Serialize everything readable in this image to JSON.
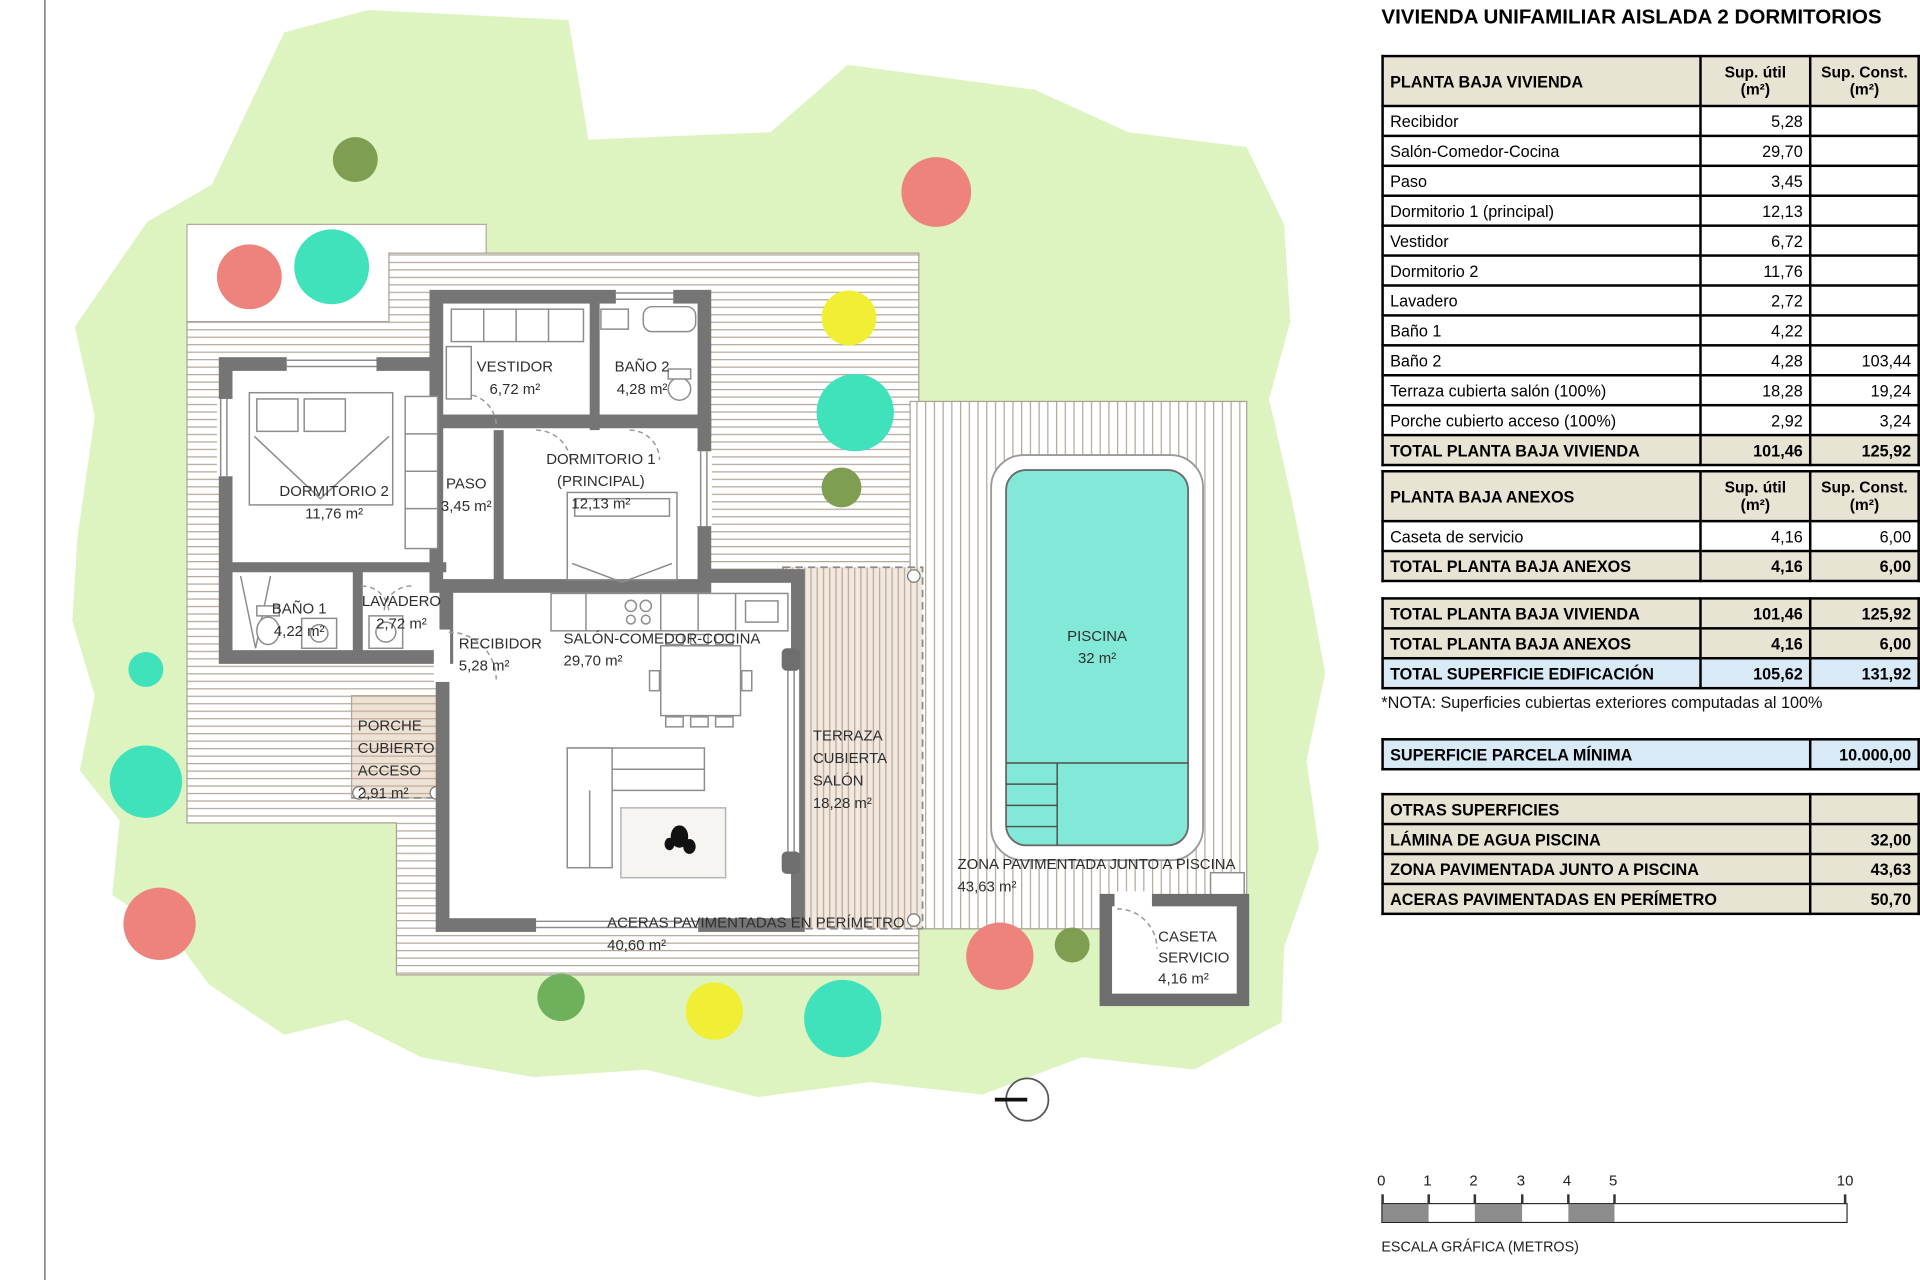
{
  "title": "VIVIENDA UNIFAMILIAR AISLADA 2 DORMITORIOS",
  "tables": {
    "col_util": "Sup. útil\n(m²)",
    "col_const": "Sup. Const.\n(m²)",
    "vivienda": {
      "header": "PLANTA BAJA VIVIENDA",
      "rows": [
        {
          "label": "Recibidor",
          "util": "5,28",
          "const": ""
        },
        {
          "label": "Salón-Comedor-Cocina",
          "util": "29,70",
          "const": ""
        },
        {
          "label": "Paso",
          "util": "3,45",
          "const": ""
        },
        {
          "label": "Dormitorio 1 (principal)",
          "util": "12,13",
          "const": ""
        },
        {
          "label": "Vestidor",
          "util": "6,72",
          "const": ""
        },
        {
          "label": "Dormitorio 2",
          "util": "11,76",
          "const": ""
        },
        {
          "label": "Lavadero",
          "util": "2,72",
          "const": ""
        },
        {
          "label": "Baño 1",
          "util": "4,22",
          "const": ""
        },
        {
          "label": "Baño 2",
          "util": "4,28",
          "const": "103,44"
        },
        {
          "label": "Terraza cubierta salón (100%)",
          "util": "18,28",
          "const": "19,24"
        },
        {
          "label": "Porche cubierto acceso (100%)",
          "util": "2,92",
          "const": "3,24"
        }
      ],
      "total": {
        "label": "TOTAL PLANTA BAJA VIVIENDA",
        "util": "101,46",
        "const": "125,92"
      }
    },
    "anexos": {
      "header": "PLANTA BAJA ANEXOS",
      "rows": [
        {
          "label": "Caseta de servicio",
          "util": "4,16",
          "const": "6,00"
        }
      ],
      "total": {
        "label": "TOTAL PLANTA BAJA ANEXOS",
        "util": "4,16",
        "const": "6,00"
      }
    },
    "resumen": {
      "rows": [
        {
          "label": "TOTAL PLANTA BAJA VIVIENDA",
          "util": "101,46",
          "const": "125,92"
        },
        {
          "label": "TOTAL PLANTA BAJA ANEXOS",
          "util": "4,16",
          "const": "6,00"
        },
        {
          "label": "TOTAL SUPERFICIE EDIFICACIÓN",
          "util": "105,62",
          "const": "131,92"
        }
      ]
    },
    "nota": "*NOTA: Superficies cubiertas exteriores computadas al 100%",
    "parcela": {
      "label": "SUPERFICIE PARCELA MÍNIMA",
      "value": "10.000,00"
    },
    "otras": {
      "header": "OTRAS SUPERFICIES",
      "rows": [
        {
          "label": "LÁMINA DE AGUA PISCINA",
          "value": "32,00"
        },
        {
          "label": "ZONA PAVIMENTADA JUNTO A PISCINA",
          "value": "43,63"
        },
        {
          "label": "ACERAS PAVIMENTADAS EN PERÍMETRO",
          "value": "50,70"
        }
      ]
    }
  },
  "scalebar": {
    "ticks": [
      "0",
      "1",
      "2",
      "3",
      "4",
      "5",
      "10"
    ],
    "label": "ESCALA GRÁFICA (METROS)"
  },
  "plan": {
    "dorm2": {
      "l1": "DORMITORIO 2",
      "area": "11,76 m²"
    },
    "bano1": {
      "l1": "BAÑO 1",
      "area": "4,22 m²"
    },
    "lavadero": {
      "l1": "LAVADERO",
      "area": "2,72 m²"
    },
    "vestidor": {
      "l1": "VESTIDOR",
      "area": "6,72 m²"
    },
    "bano2": {
      "l1": "BAÑO 2",
      "area": "4,28 m²"
    },
    "dorm1": {
      "l1": "DORMITORIO 1",
      "l2": "(PRINCIPAL)",
      "area": "12,13 m²"
    },
    "paso": {
      "l1": "PASO",
      "area": "3,45 m²"
    },
    "recibidor": {
      "l1": "RECIBIDOR",
      "area": "5,28 m²"
    },
    "salon": {
      "l1": "SALÓN-COMEDOR-COCINA",
      "area": "29,70 m²"
    },
    "porche": {
      "l1": "PORCHE",
      "l2": "CUBIERTO",
      "l3": "ACCESO",
      "area": "2,91 m²"
    },
    "terraza": {
      "l1": "TERRAZA",
      "l2": "CUBIERTA",
      "l3": "SALÓN",
      "area": "18,28 m²"
    },
    "piscina": {
      "l1": "PISCINA",
      "area": "32 m²"
    },
    "zona": {
      "l1": "ZONA PAVIMENTADA JUNTO A PISCINA",
      "area": "43,63 m²"
    },
    "aceras": {
      "l1": "ACERAS PAVIMENTADAS EN PERÍMETRO",
      "area": "40,60 m²"
    },
    "caseta": {
      "l1": "CASETA",
      "l2": "SERVICIO",
      "area": "4,16 m²"
    }
  },
  "colors": {
    "garden_green": "#ddf4c1",
    "pool_water": "#82e9d9",
    "wall_gray": "#757575",
    "table_beige": "#e8e4d3",
    "highlight_blue": "#d7eaf6",
    "tree_red": "#ee837d",
    "tree_teal": "#3fe2bb",
    "tree_yellow": "#f0ee35",
    "tree_olive": "#7f9e52",
    "tree_green": "#6fb05c",
    "scale_gray": "#8c8c8c"
  }
}
